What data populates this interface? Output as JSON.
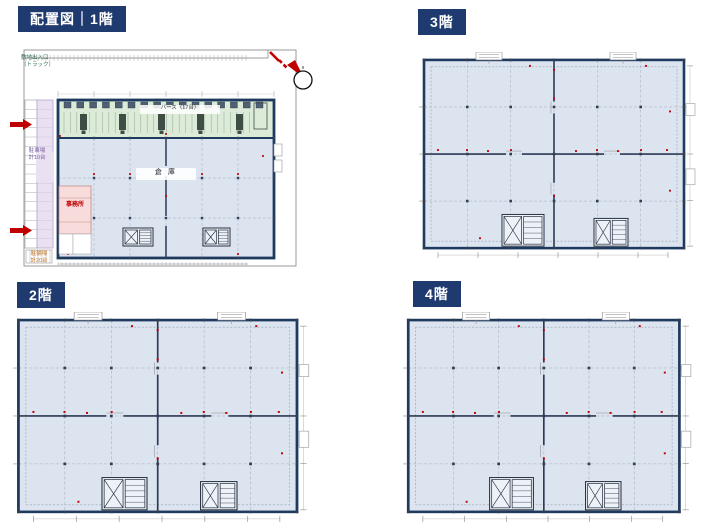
{
  "colors": {
    "badge_bg": "#1e3a6e",
    "badge_text": "#ffffff",
    "plan_fill": "#dce4f0",
    "berth_fill": "#dcead8",
    "parking_fill": "#e9e1f2",
    "office_fill": "#f8dcdb",
    "outline_navy": "#1f3a5f",
    "wall_dark": "#2c3a55",
    "marker_red": "#c00000",
    "boundary_gray": "#8f8f8f"
  },
  "panels": {
    "floor1": {
      "badge": "配置図｜1階",
      "labels": {
        "site_entrance_line1": "敷地出入口",
        "site_entrance_line2": "（トラック）",
        "parking_line1": "駐車場",
        "parking_line2": "計10台",
        "bicycle_line1": "駐輪場",
        "bicycle_line2": "計20台",
        "berth": "バース（17台）",
        "warehouse": "倉 庫",
        "office": "事務所"
      }
    },
    "floor2": {
      "badge": "2階"
    },
    "floor3": {
      "badge": "3階"
    },
    "floor4": {
      "badge": "4階"
    }
  }
}
